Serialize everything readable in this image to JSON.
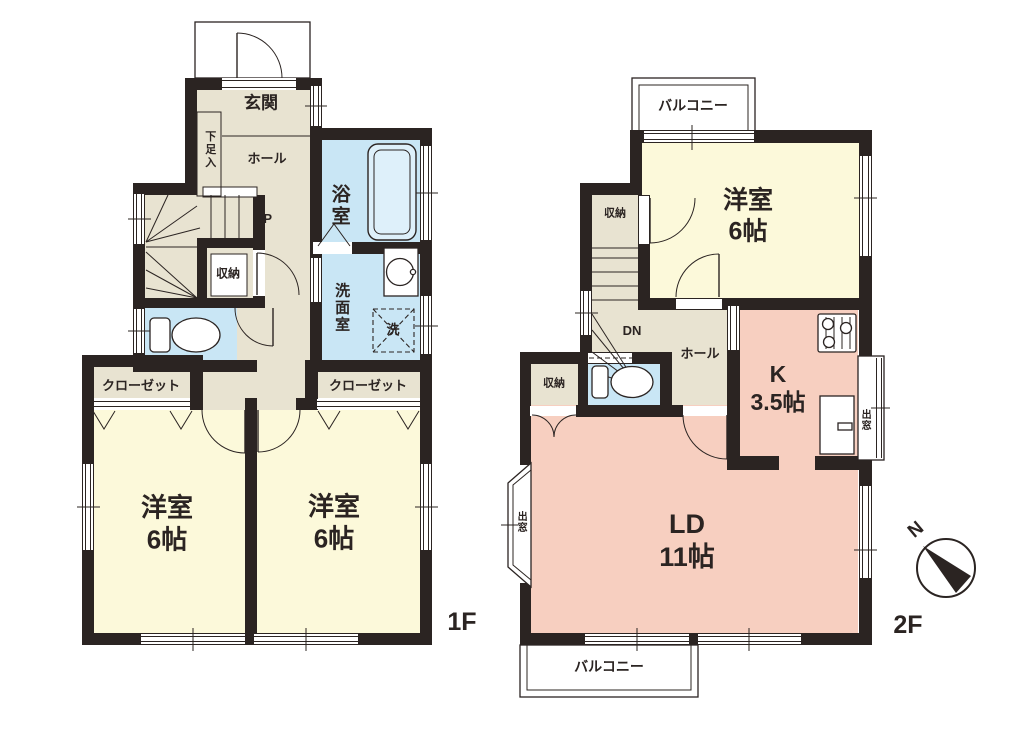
{
  "palette": {
    "wall": "#2b2422",
    "circulation_beige": "#e8e3d1",
    "room_yellow": "#fcf9da",
    "water_blue": "#c9e6f5",
    "living_pink": "#f7cfc0",
    "background": "#ffffff"
  },
  "floor1": {
    "floor_label": "1F",
    "entrance": "玄関",
    "hall": "ホール",
    "shoe_cabinet": "下足入",
    "stairs_up": "UP",
    "bathroom": "浴室",
    "washroom": "洗面室",
    "laundry": "洗",
    "storage": "収納",
    "closet_left": "クローゼット",
    "closet_right": "クローゼット",
    "room_left": {
      "name": "洋室",
      "size": "6帖"
    },
    "room_right": {
      "name": "洋室",
      "size": "6帖"
    }
  },
  "floor2": {
    "floor_label": "2F",
    "balcony_top": "バルコニー",
    "balcony_bottom": "バルコニー",
    "room": {
      "name": "洋室",
      "size": "6帖"
    },
    "storage_upper": "収納",
    "storage_lower": "収納",
    "stairs_down": "DN",
    "hall": "ホール",
    "kitchen": {
      "name": "K",
      "size": "3.5帖"
    },
    "living_dining": {
      "name": "LD",
      "size": "11帖"
    },
    "bay_window_left": "出窓",
    "bay_window_right": "出窓"
  },
  "compass": {
    "north": "N"
  }
}
